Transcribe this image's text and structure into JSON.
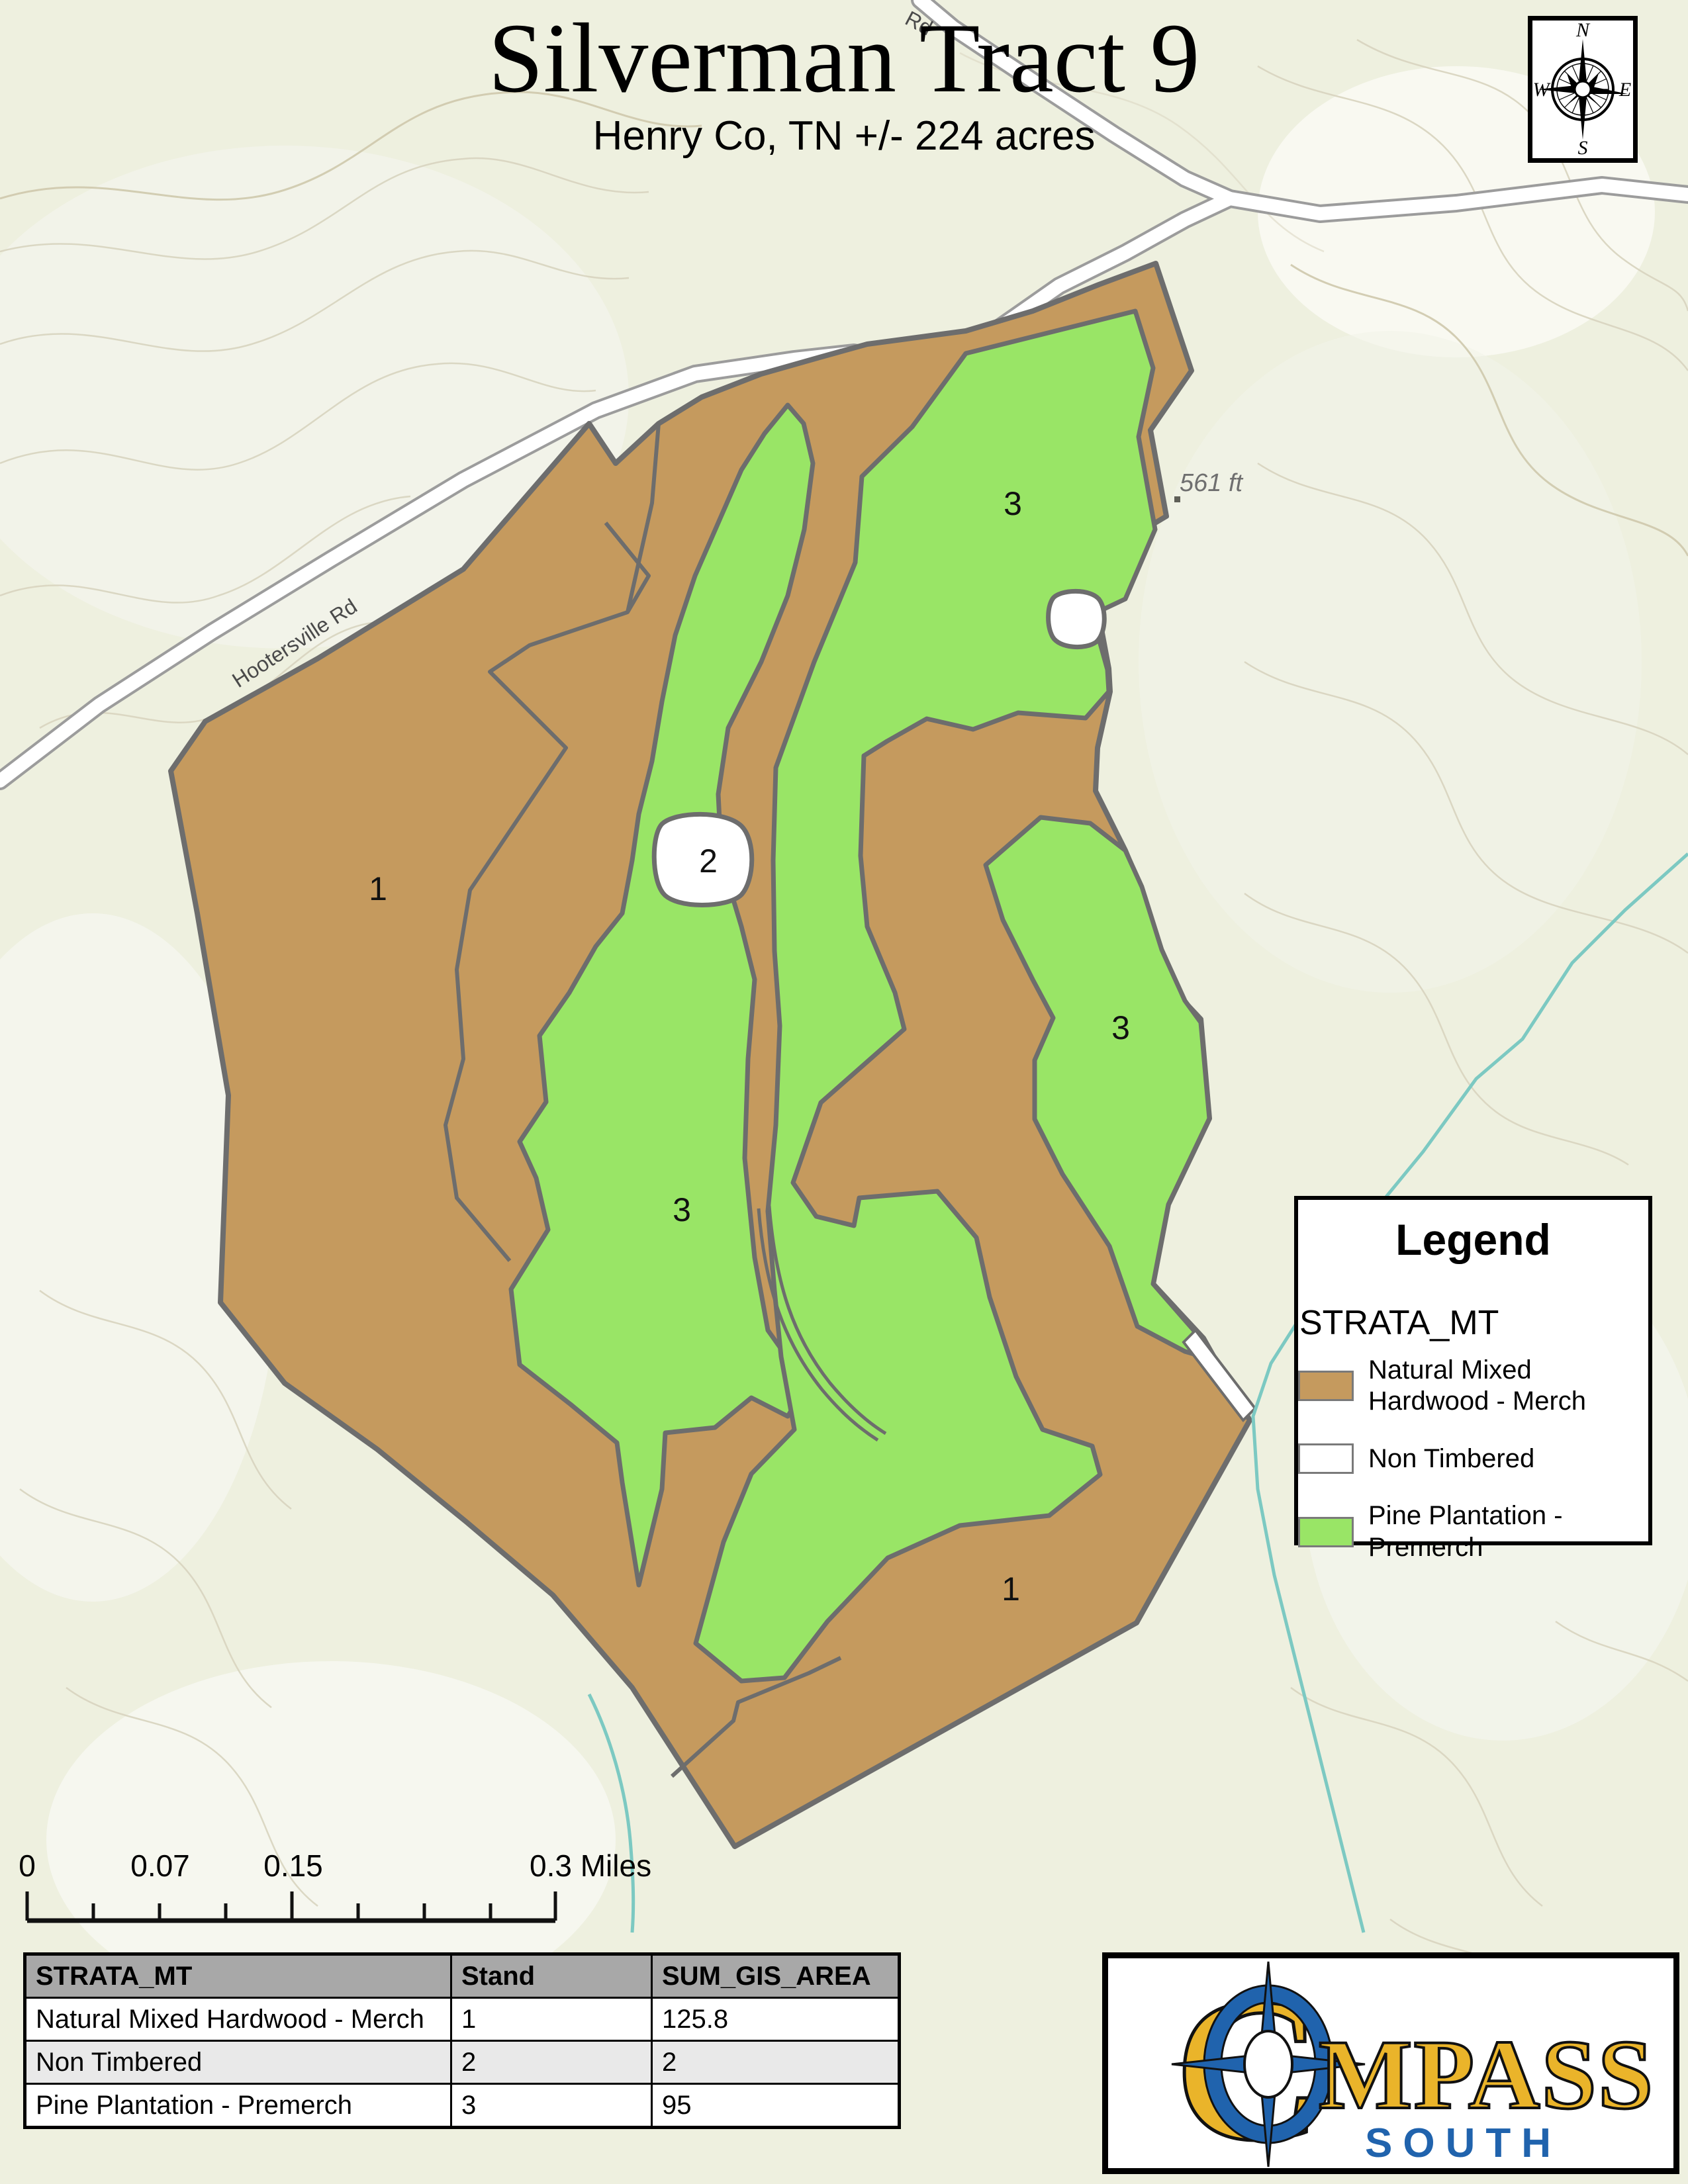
{
  "title": {
    "main": "Silverman Tract 9",
    "subtitle": "Henry Co, TN +/- 224 acres"
  },
  "compass": {
    "n": "N",
    "e": "E",
    "s": "S",
    "w": "W"
  },
  "map": {
    "road_label_nw": "Hootersville Rd",
    "road_label_top": "Rd",
    "spot_elevation": "561 ft",
    "stand_labels": [
      {
        "text": "1",
        "area": "west-hardwood"
      },
      {
        "text": "2",
        "area": "non-timbered-pond"
      },
      {
        "text": "3",
        "area": "northeast-pine"
      },
      {
        "text": "3",
        "area": "central-pine"
      },
      {
        "text": "3",
        "area": "east-pine"
      },
      {
        "text": "1",
        "area": "south-hardwood"
      }
    ]
  },
  "legend": {
    "title": "Legend",
    "layer": "STRATA_MT",
    "items": [
      {
        "label_line1": "Natural Mixed",
        "label_line2": "Hardwood - Merch",
        "color": "#c59a5e"
      },
      {
        "label_line1": "Non Timbered",
        "label_line2": "",
        "color": "#ffffff"
      },
      {
        "label_line1": "Pine Plantation -",
        "label_line2": "Premerch",
        "color": "#99e566"
      }
    ]
  },
  "scale_bar": {
    "labels": [
      "0",
      "0.07",
      "0.15",
      "0.3 Miles"
    ],
    "units": "Miles"
  },
  "table": {
    "headers": [
      "STRATA_MT",
      "Stand",
      "SUM_GIS_AREA"
    ],
    "rows": [
      [
        "Natural Mixed Hardwood - Merch",
        "1",
        "125.8"
      ],
      [
        "Non Timbered",
        "2",
        "2"
      ],
      [
        "Pine Plantation - Premerch",
        "3",
        "95"
      ]
    ]
  },
  "logo": {
    "c": "C",
    "rest": "MPASS",
    "south": "SOUTH"
  },
  "colors": {
    "map_background": "#eef0df",
    "hardwood_brown": "#c59a5e",
    "pine_green": "#99e566",
    "non_timbered_white": "#ffffff",
    "boundary_gray": "#6d6d6d",
    "road_casing_gray": "#9c9c9c",
    "stream_teal": "#7cc9c2",
    "contour_tan": "#d8d4bf",
    "table_header_gray": "#a8a8a8",
    "logo_gold": "#eab42a",
    "logo_blue": "#2063ad"
  }
}
